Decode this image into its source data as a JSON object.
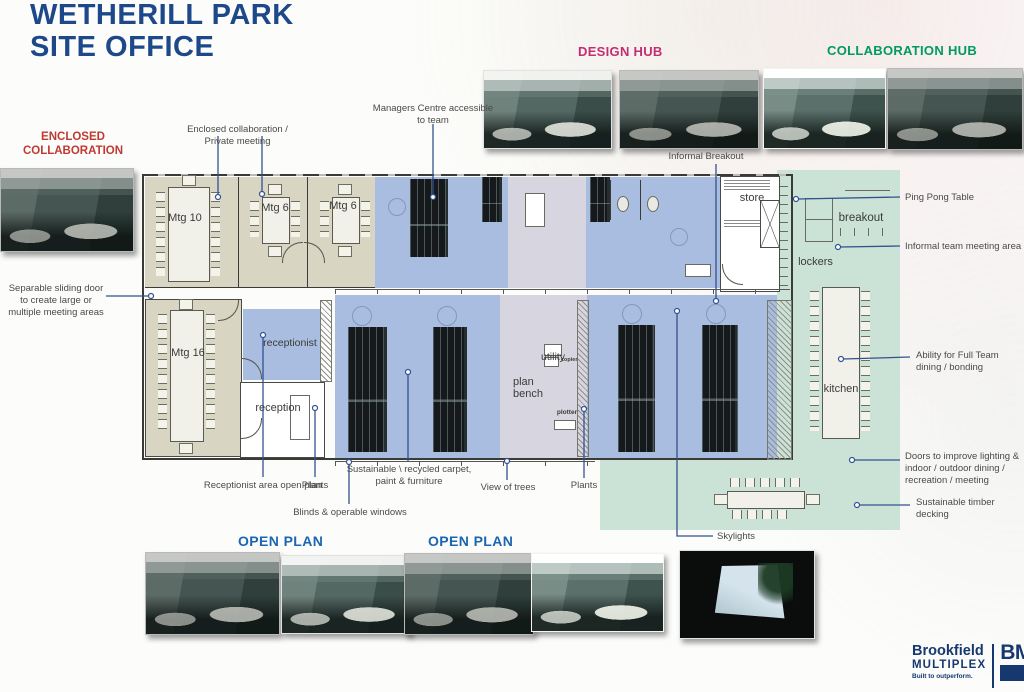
{
  "title": {
    "line1": "WETHERILL PARK",
    "line2": "SITE OFFICE"
  },
  "sections": {
    "enclosed_collaboration": "ENCLOSED COLLABORATION",
    "design_hub": "DESIGN HUB",
    "collaboration_hub": "COLLABORATION HUB",
    "open_plan_left": "OPEN PLAN",
    "open_plan_right": "OPEN PLAN"
  },
  "callouts": {
    "enclosed_private": "Enclosed collaboration / Private meeting",
    "managers_centre": "Managers Centre accessible to team",
    "informal_breakout": "Informal Breakout",
    "separable_door": "Separable sliding door to create large or multiple meeting areas",
    "ping_pong": "Ping Pong Table",
    "informal_team": "Informal team meeting area",
    "full_team_dining": "Ability for Full Team dining / bonding",
    "doors_improve": "Doors to improve lighting & indoor / outdoor dining / recreation / meeting",
    "timber_decking": "Sustainable timber decking",
    "receptionist_area": "Receptionist area open plan",
    "plants_left": "Plants",
    "blinds": "Blinds & operable windows",
    "sustainable_carpet": "Sustainable \\ recycled carpet, paint & furniture",
    "view_of_trees": "View of trees",
    "plants_right": "Plants",
    "skylights": "Skylights"
  },
  "rooms": {
    "mtg10": "Mtg 10",
    "mtg6a": "Mtg 6",
    "mtg6b": "Mtg 6",
    "mtg16": "Mtg 16",
    "receptionist": "receptionist",
    "reception": "reception",
    "utility": "utility",
    "copier": "copier",
    "plan_bench": "plan bench",
    "plotter": "plotter",
    "store": "store",
    "lockers": "lockers",
    "breakout": "breakout",
    "kitchen": "kitchen"
  },
  "logo": {
    "brand": "Brookfield",
    "brand_sub": "MULTIPLEX",
    "tagline": "Built to outperform.",
    "monogram": "BM"
  },
  "colors": {
    "title": "#1d4889",
    "design_hub": "#c52d72",
    "collaboration_hub": "#019a60",
    "enclosed_collaboration": "#bf3a33",
    "open_plan": "#1b66b3",
    "leader_line": "#33518f",
    "zone_tan": "#d8d5c2",
    "zone_blue": "#a8bddf",
    "zone_lavender": "#d7d6e0",
    "zone_green": "#cbe3d6"
  }
}
